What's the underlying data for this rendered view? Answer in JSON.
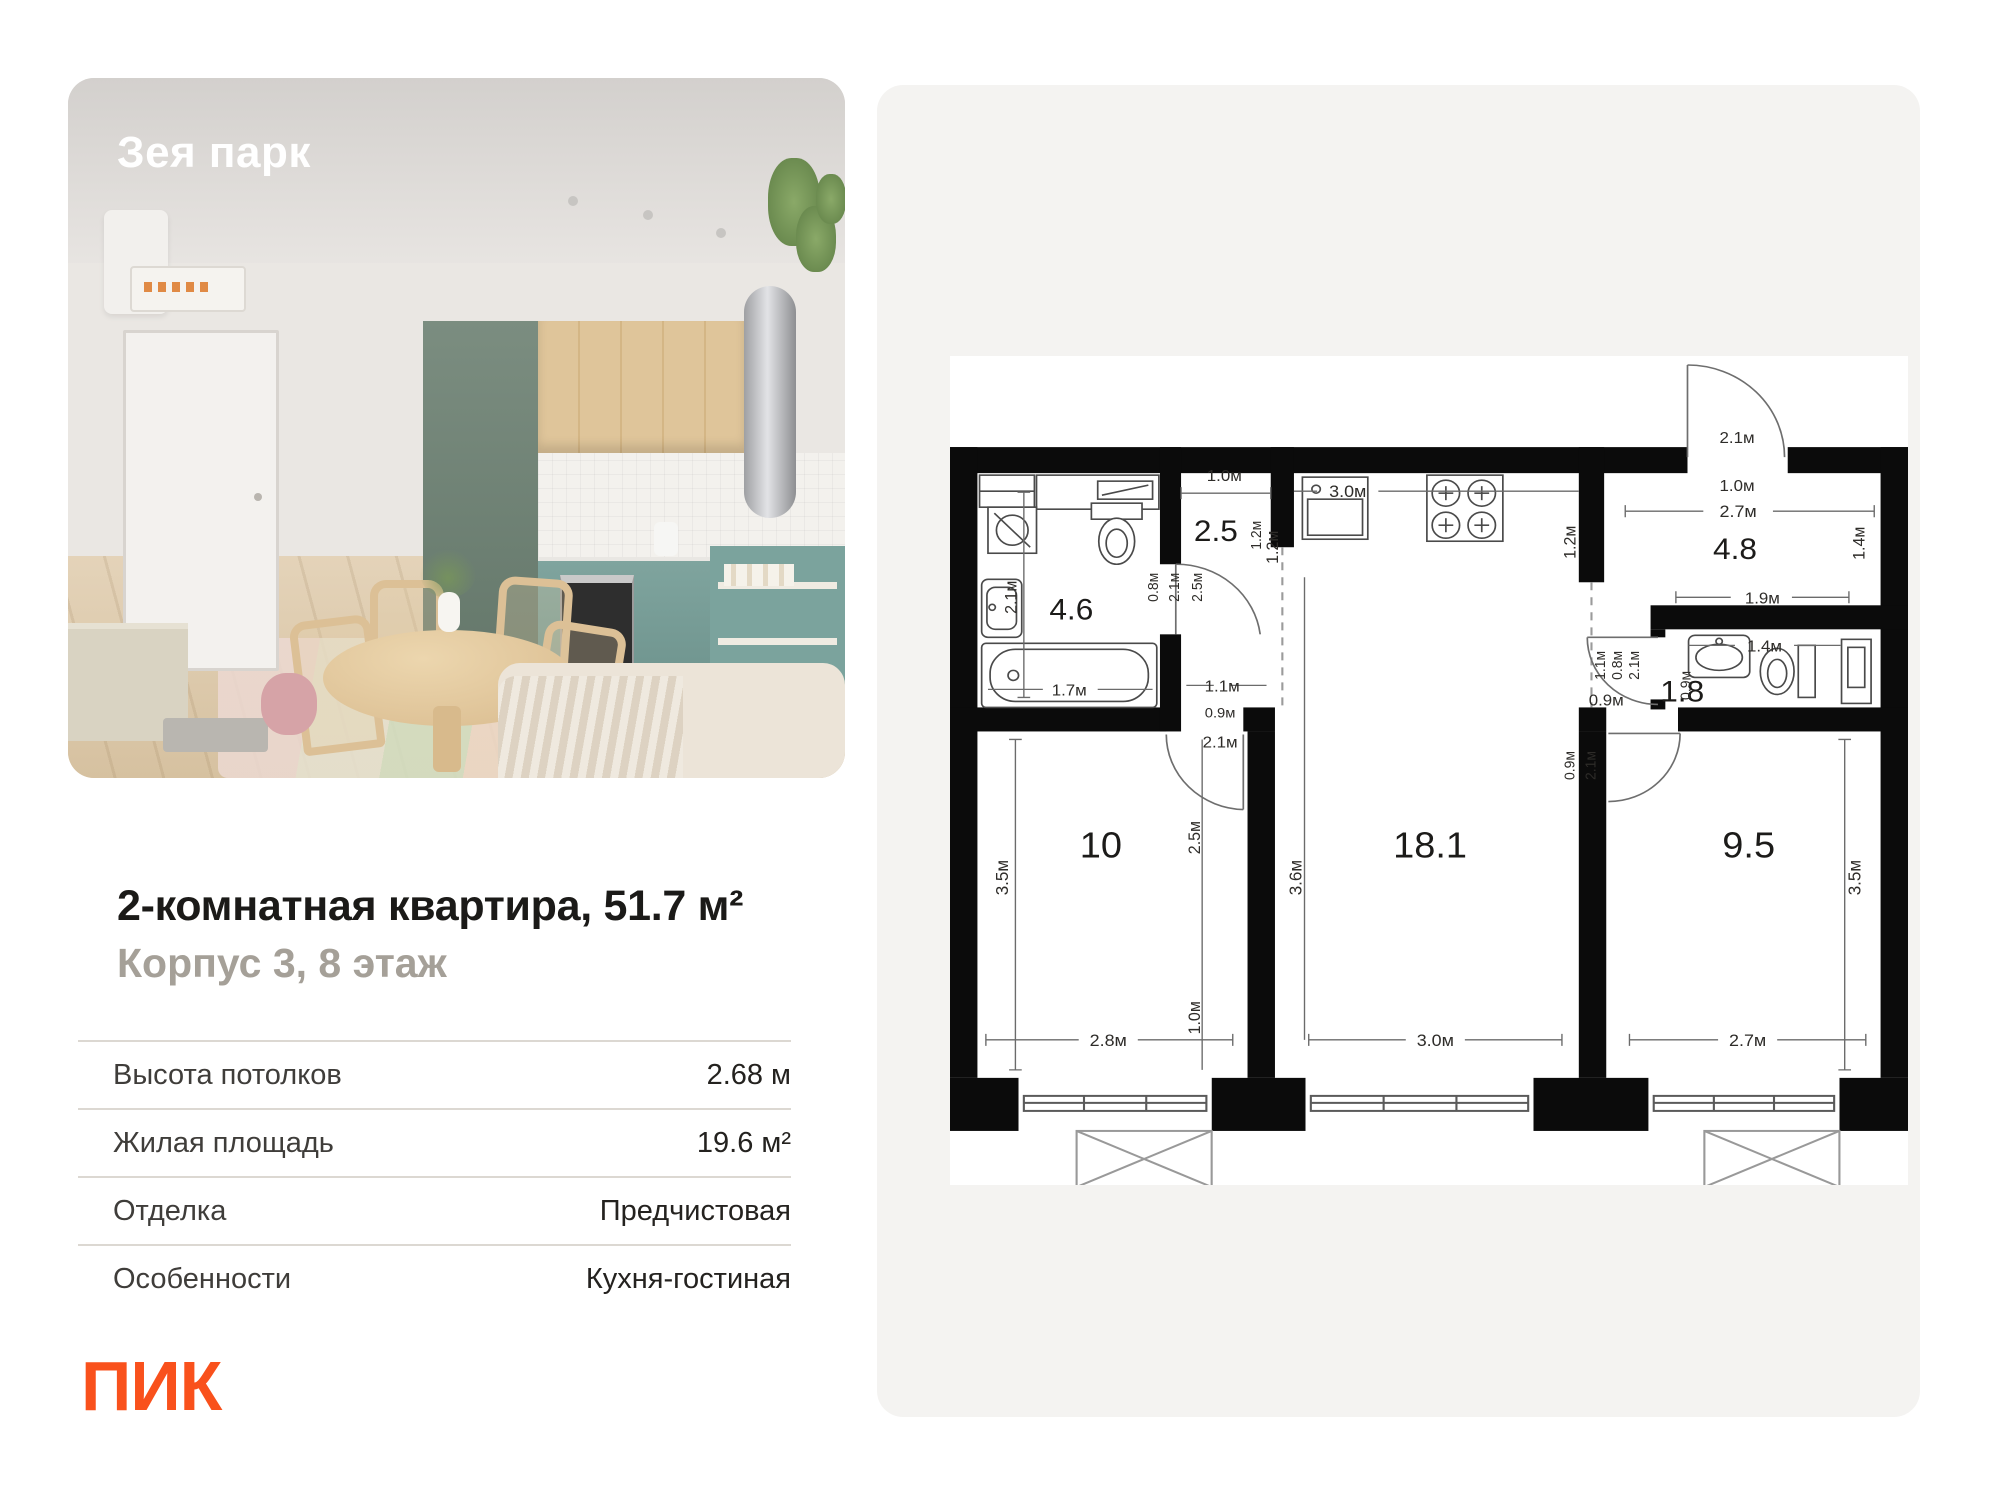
{
  "photo": {
    "project_name": "Зея парк"
  },
  "listing": {
    "title": "2-комнатная квартира, 51.7 м²",
    "subtitle": "Корпус 3, 8 этаж"
  },
  "specs": {
    "rows": [
      {
        "label": "Высота потолков",
        "value": "2.68 м"
      },
      {
        "label": "Жилая площадь",
        "value": "19.6 м²"
      },
      {
        "label": "Отделка",
        "value": "Предчистовая"
      },
      {
        "label": "Особенности",
        "value": "Кухня-гостиная"
      }
    ]
  },
  "brand": {
    "logo": "ПИК",
    "color": "#F9511C"
  },
  "plan": {
    "rooms": {
      "bath": "4.6",
      "hall": "2.5",
      "entry": "4.8",
      "wc": "1.8",
      "bedroom1": "10",
      "living": "18.1",
      "bedroom2": "9.5"
    },
    "dims": {
      "hall_width": "1.0м",
      "hall_depth": "1.2м",
      "hall_door": "2.5м",
      "hall_door2": "2.1м",
      "bath_niche": "0.8м",
      "bath_height": "2.1м",
      "tub": "1.7м",
      "lobby_w": "1.1м",
      "lobby_o": "0.9м",
      "r10_door": "2.1м",
      "kitchen_w": "3.0м",
      "kitchen_left": "1.2м",
      "kitchen_right": "1.2м",
      "entry_door": "2.1м",
      "entry_w": "1.0м",
      "hall48_w": "2.7м",
      "hall48_d": "1.4м",
      "hall48_b": "1.9м",
      "wc_w": "1.4м",
      "wc_d": "0.9м",
      "wc_door_w": "1.1м",
      "wc_door_o": "0.8м",
      "wc_door_h": "2.1м",
      "wc_door_x": "0.9м",
      "r95_door_w": "0.9м",
      "r95_door_h": "2.1м",
      "r10_h": "3.5м",
      "r10_w": "2.8м",
      "r10_inner": "2.5м",
      "r10_gap": "1.0м",
      "r18_h": "3.6м",
      "r18_w": "3.0м",
      "r95_h": "3.5м",
      "r95_w": "2.7м"
    }
  }
}
